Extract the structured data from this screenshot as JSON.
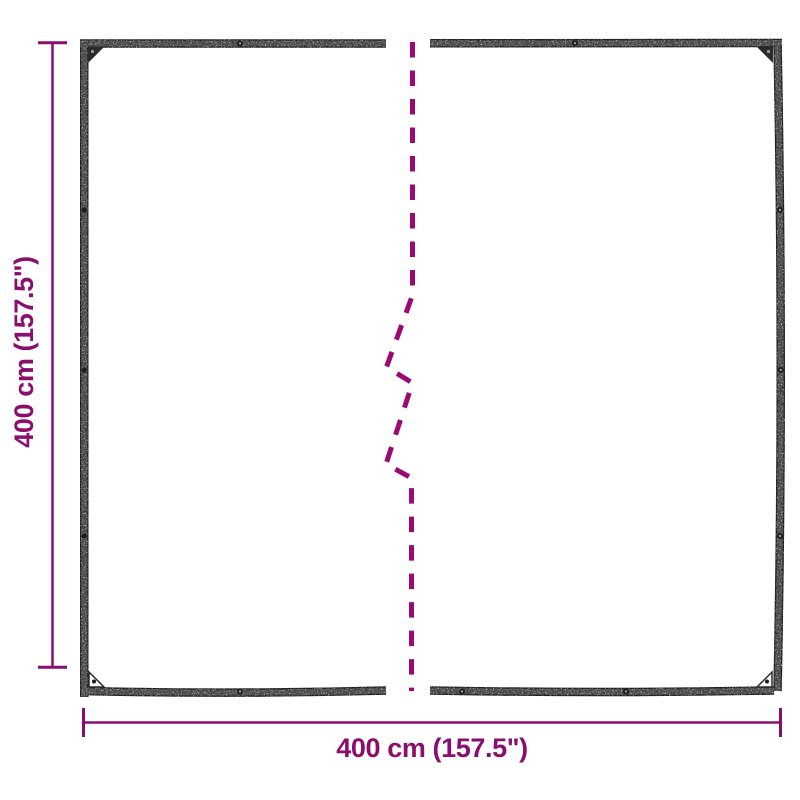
{
  "labels": {
    "width": "400 cm (157.5\")",
    "height": "400 cm (157.5\")"
  },
  "colors": {
    "dimension": "#8A0E6E",
    "break_line": "#9B0A73",
    "tarp_edge": "#4D4D4D",
    "background": "#FFFFFF"
  }
}
